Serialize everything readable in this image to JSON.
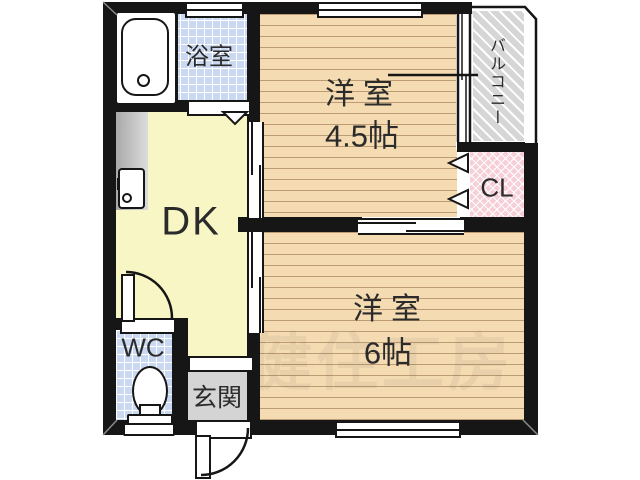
{
  "floorplan": {
    "rooms": {
      "bathroom": {
        "label": "浴室"
      },
      "dining_kitchen": {
        "label": "DK"
      },
      "toilet": {
        "label": "WC"
      },
      "entrance": {
        "label": "玄関"
      },
      "closet": {
        "label": "CL"
      },
      "balcony": {
        "label": "バルコニー"
      },
      "western_room_top": {
        "label": "洋室",
        "size": "4.5帖"
      },
      "western_room_bottom": {
        "label": "洋室",
        "size": "6帖"
      }
    },
    "watermark": "健住工房",
    "palette": {
      "wall": "#161616",
      "wood_floor": "#f4dbb2",
      "wood_line": "#bb9c74",
      "dk_floor": "#f8f6c4",
      "tile_floor": "#cbd8f1",
      "closet_floor": "#f6cfd8",
      "balcony_floor": "#d6d6d6",
      "entrance_floor": "#d4d4d4"
    }
  }
}
